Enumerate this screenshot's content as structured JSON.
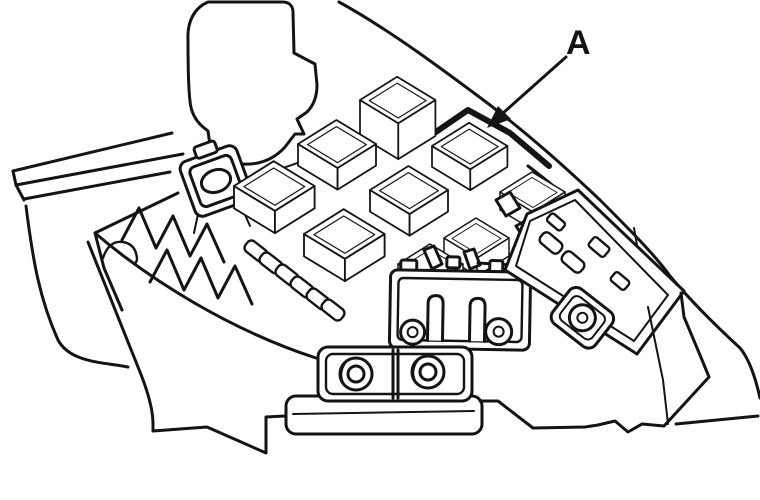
{
  "figure": {
    "kind": "engine-compartment-fuse-relay-box-line-drawing",
    "callouts": [
      {
        "label": "A"
      }
    ]
  },
  "colors": {
    "ink": "#141414",
    "paper": "#ffffff"
  }
}
